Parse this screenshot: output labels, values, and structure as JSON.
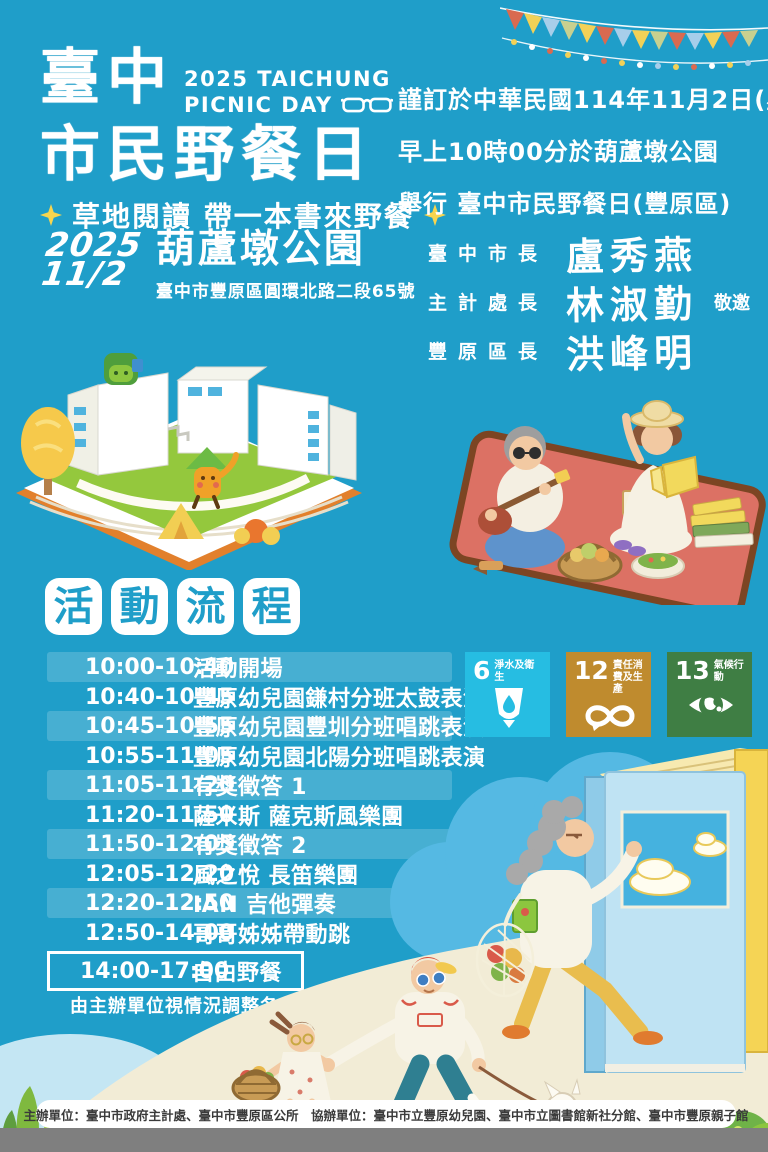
{
  "poster": {
    "title_line1": "臺中",
    "title_line2": "市民野餐日",
    "title_en_line1": "2025 TAICHUNG",
    "title_en_line2": "PICNIC DAY",
    "subtitle": "草地閱讀 帶一本書來野餐"
  },
  "invitation": {
    "line1": "謹訂於中華民國114年11月2日(星期日)",
    "line2": "早上10時00分於葫蘆墩公園",
    "line3": "舉行 臺中市民野餐日(豐原區)"
  },
  "event": {
    "year": "2025",
    "date": "11/2",
    "venue": "葫蘆墩公園",
    "address": "臺中市豐原區圓環北路二段65號"
  },
  "officials": [
    {
      "title": "臺中市長",
      "name": "盧秀燕",
      "suffix": ""
    },
    {
      "title": "主計處長",
      "name": "林淑勤",
      "suffix": "敬邀"
    },
    {
      "title": "豐原區長",
      "name": "洪峰明",
      "suffix": ""
    }
  ],
  "schedule": {
    "heading": [
      "活",
      "動",
      "流",
      "程"
    ],
    "rows": [
      {
        "time": "10:00-10:40",
        "activity": "活動開場"
      },
      {
        "time": "10:40-10:45",
        "activity": "豐原幼兒園鎌村分班太鼓表演"
      },
      {
        "time": "10:45-10:55",
        "activity": "豐原幼兒園豐圳分班唱跳表演"
      },
      {
        "time": "10:55-11:05",
        "activity": "豐原幼兒園北陽分班唱跳表演"
      },
      {
        "time": "11:05-11:20",
        "activity": "有獎徵答 1"
      },
      {
        "time": "11:20-11:50",
        "activity": "薩米斯 薩克斯風樂團"
      },
      {
        "time": "11:50-12:05",
        "activity": "有獎徵答 2"
      },
      {
        "time": "12:05-12:20",
        "activity": "風之悅 長笛樂團"
      },
      {
        "time": "12:20-12:50",
        "activity": "IAN 吉他彈奏"
      },
      {
        "time": "12:50-14:00",
        "activity": "哥哥姊姊帶動跳"
      }
    ],
    "highlight": {
      "time": "14:00-17:00",
      "activity": "自由野餐"
    },
    "note": "由主辦單位視情況調整各項活動時間"
  },
  "sdg": [
    {
      "number": "6",
      "label": "淨水及衛生",
      "color": "#26BDE2",
      "icon": "water-glass-drop"
    },
    {
      "number": "12",
      "label": "責任消費及生產",
      "color": "#BF8B2E",
      "icon": "infinity-loop"
    },
    {
      "number": "13",
      "label": "氣候行動",
      "color": "#3F7E44",
      "icon": "eye-globe"
    }
  ],
  "credits": "主辦單位：臺中市政府主計處、臺中市豐原區公所　協辦單位：臺中市立豐原幼兒園、臺中市立圖書館新社分館、臺中市豐原親子館",
  "icons": {
    "sunglasses": "sunglasses-outline",
    "sparkle": "four-point-star",
    "bunting": "pennant-garland"
  },
  "colors": {
    "background": "#1F9EC9",
    "schedule_stripe": "rgba(255,255,255,0.18)",
    "heading_tile": "#FFFFFF",
    "heading_text": "#1F9EC9",
    "sparkle_yellow": "#F7D54E",
    "sdg6": "#26BDE2",
    "sdg12": "#BF8B2E",
    "sdg13": "#3F7E44",
    "credits_bar": "#FFFFFF",
    "credits_text": "#3A3A3A",
    "bottom_bar": "#7F7F7F"
  }
}
